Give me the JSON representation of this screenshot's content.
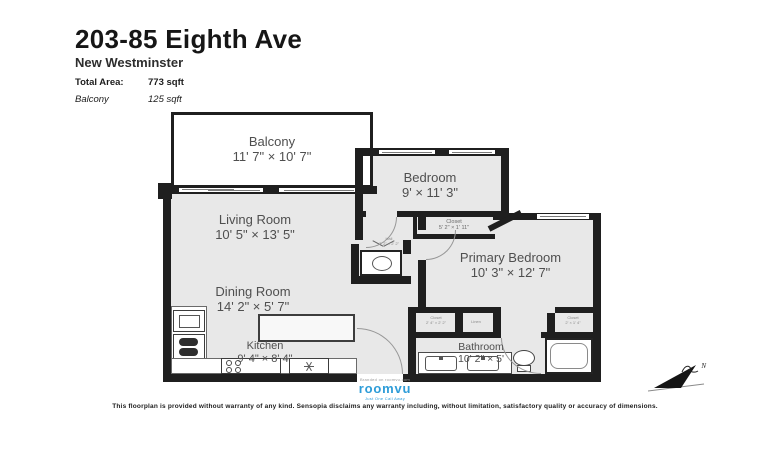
{
  "header": {
    "title": "203-85 Eighth Ave",
    "city": "New Westminster",
    "total_area_label": "Total Area:",
    "total_area_value": "773 sqft",
    "balcony_label": "Balcony",
    "balcony_value": "125 sqft"
  },
  "rooms": {
    "balcony": {
      "name": "Balcony",
      "dims": "11' 7\" × 10' 7\""
    },
    "living": {
      "name": "Living Room",
      "dims": "10' 5\" × 13' 5\""
    },
    "dining": {
      "name": "Dining Room",
      "dims": "14' 2\" × 5' 7\""
    },
    "kitchen": {
      "name": "Kitchen",
      "dims": "9' 4\" × 8' 4\""
    },
    "bedroom": {
      "name": "Bedroom",
      "dims": "9' × 11' 3\""
    },
    "bedroom_closet": {
      "name": "Closet",
      "dims": "5' 2\" × 1' 11\""
    },
    "primary": {
      "name": "Primary Bedroom",
      "dims": "10' 3\" × 12' 7\""
    },
    "bathroom": {
      "name": "Bathroom",
      "dims": "10' 2\" × 5'"
    },
    "hall": {
      "name": "Hall",
      "dims": "7' 2\" × 2' 2\""
    },
    "entry_closet": {
      "name": "Closet",
      "dims": "2' 4\" × 2' 2\""
    },
    "linen": {
      "name": "Linen",
      "dims": ""
    },
    "primary_closet": {
      "name": "Closet",
      "dims": "2' × 1' 4\""
    }
  },
  "branding": {
    "powered_by": "Branded on roomvu.com",
    "logo_text": "roomvu",
    "tagline": "Just One Call Away"
  },
  "compass": {
    "label": "N"
  },
  "footer": {
    "disclaimer": "This floorplan is provided without warranty of any kind. Sensopia disclaims any warranty including, without limitation, satisfactory quality or accuracy of dimensions."
  },
  "colors": {
    "wall": "#1f1f1f",
    "floor": "#e8e8e8",
    "brand_blue": "#2d9cd8"
  }
}
